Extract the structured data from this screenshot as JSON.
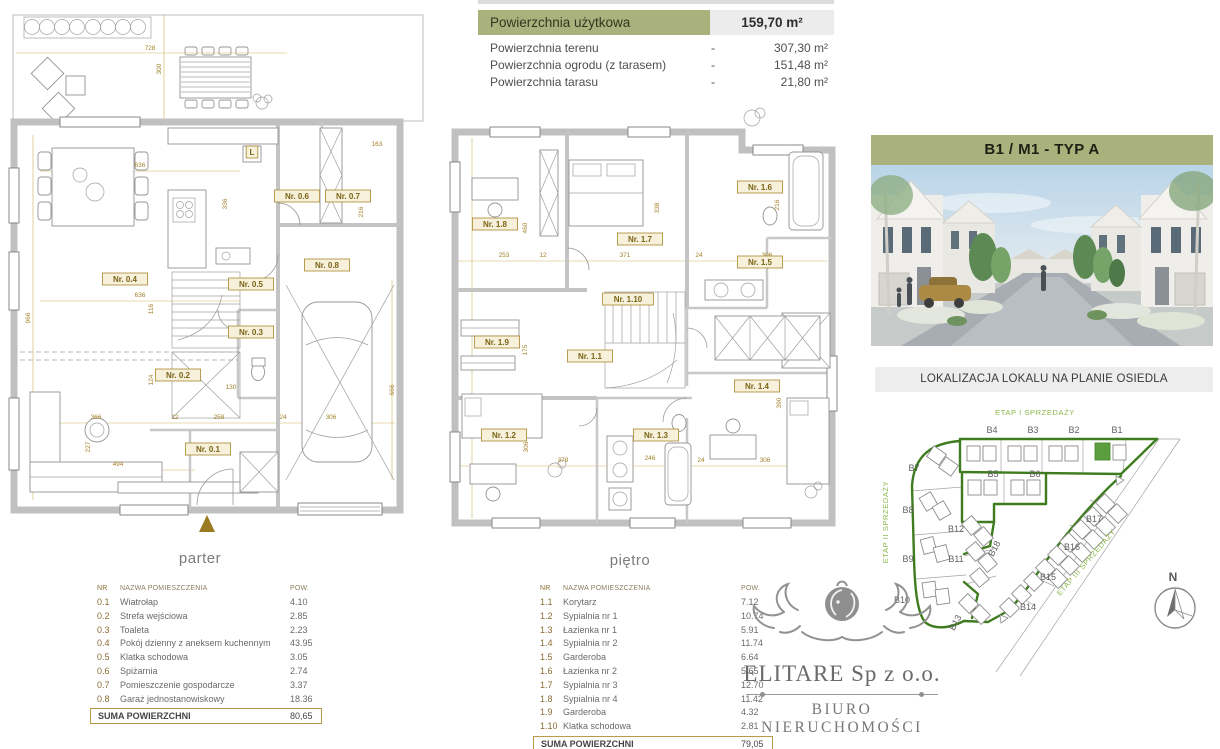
{
  "summary": {
    "header": {
      "label": "Powierzchnia użytkowa",
      "value": "159,70 m²"
    },
    "rows": [
      {
        "label": "Powierzchnia terenu",
        "dash": "-",
        "value": "307,30 m²"
      },
      {
        "label": "Powierzchnia ogrodu (z tarasem)",
        "dash": "-",
        "value": "151,48 m²"
      },
      {
        "label": "Powierzchnia tarasu",
        "dash": "-",
        "value": "21,80 m²"
      }
    ]
  },
  "unit_header": "B1 / M1 - TYP A",
  "location_title": "LOKALIZACJA LOKALU NA PLANIE OSIEDLA",
  "plans": {
    "parter": {
      "caption": "parter",
      "room_labels": [
        {
          "t": "Nr. 0.1",
          "x": 208,
          "y": 452
        },
        {
          "t": "Nr. 0.2",
          "x": 178,
          "y": 378
        },
        {
          "t": "Nr. 0.3",
          "x": 251,
          "y": 335
        },
        {
          "t": "Nr. 0.4",
          "x": 125,
          "y": 282
        },
        {
          "t": "Nr. 0.5",
          "x": 251,
          "y": 287
        },
        {
          "t": "Nr. 0.6",
          "x": 297,
          "y": 199
        },
        {
          "t": "Nr. 0.7",
          "x": 348,
          "y": 199
        },
        {
          "t": "Nr. 0.8",
          "x": 327,
          "y": 268
        },
        {
          "t": "L",
          "x": 252,
          "y": 155
        }
      ],
      "dims": [
        {
          "t": "728",
          "x": 150,
          "y": 50
        },
        {
          "t": "300",
          "x": 161,
          "y": 69,
          "r": -90
        },
        {
          "t": "636",
          "x": 140,
          "y": 167
        },
        {
          "t": "163",
          "x": 377,
          "y": 146
        },
        {
          "t": "216",
          "x": 363,
          "y": 212,
          "r": -90
        },
        {
          "t": "336",
          "x": 227,
          "y": 204,
          "r": -90
        },
        {
          "t": "636",
          "x": 140,
          "y": 297
        },
        {
          "t": "966",
          "x": 30,
          "y": 318,
          "r": -90
        },
        {
          "t": "116",
          "x": 153,
          "y": 309,
          "r": -90
        },
        {
          "t": "124",
          "x": 153,
          "y": 380,
          "r": -90
        },
        {
          "t": "366",
          "x": 96,
          "y": 419
        },
        {
          "t": "12",
          "x": 175,
          "y": 419
        },
        {
          "t": "258",
          "x": 219,
          "y": 419
        },
        {
          "t": "24",
          "x": 283,
          "y": 419
        },
        {
          "t": "306",
          "x": 331,
          "y": 419
        },
        {
          "t": "130",
          "x": 231,
          "y": 389
        },
        {
          "t": "494",
          "x": 118,
          "y": 466
        },
        {
          "t": "666",
          "x": 394,
          "y": 390,
          "r": -90
        },
        {
          "t": "227",
          "x": 90,
          "y": 447,
          "r": -90
        }
      ]
    },
    "pietro": {
      "caption": "piętro",
      "room_labels": [
        {
          "t": "Nr. 1.1",
          "x": 153,
          "y": 261
        },
        {
          "t": "Nr. 1.2",
          "x": 67,
          "y": 340
        },
        {
          "t": "Nr. 1.3",
          "x": 219,
          "y": 340
        },
        {
          "t": "Nr. 1.4",
          "x": 320,
          "y": 291
        },
        {
          "t": "Nr. 1.5",
          "x": 323,
          "y": 167
        },
        {
          "t": "Nr. 1.6",
          "x": 323,
          "y": 92
        },
        {
          "t": "Nr. 1.7",
          "x": 203,
          "y": 144
        },
        {
          "t": "Nr. 1.8",
          "x": 58,
          "y": 129
        },
        {
          "t": "Nr. 1.9",
          "x": 60,
          "y": 247
        },
        {
          "t": "Nr. 1.10",
          "x": 191,
          "y": 204
        }
      ],
      "dims": [
        {
          "t": "253",
          "x": 67,
          "y": 159
        },
        {
          "t": "12",
          "x": 106,
          "y": 159
        },
        {
          "t": "371",
          "x": 188,
          "y": 159
        },
        {
          "t": "24",
          "x": 262,
          "y": 159
        },
        {
          "t": "306",
          "x": 330,
          "y": 159
        },
        {
          "t": "460",
          "x": 90,
          "y": 130,
          "r": -90
        },
        {
          "t": "338",
          "x": 222,
          "y": 110,
          "r": -90
        },
        {
          "t": "216",
          "x": 342,
          "y": 107,
          "r": -90
        },
        {
          "t": "175",
          "x": 90,
          "y": 252,
          "r": -90
        },
        {
          "t": "378",
          "x": 126,
          "y": 364
        },
        {
          "t": "246",
          "x": 213,
          "y": 362
        },
        {
          "t": "24",
          "x": 264,
          "y": 364
        },
        {
          "t": "306",
          "x": 328,
          "y": 364
        },
        {
          "t": "306",
          "x": 91,
          "y": 349,
          "r": -90
        },
        {
          "t": "390",
          "x": 344,
          "y": 305,
          "r": -90
        }
      ]
    }
  },
  "tables": {
    "parter": {
      "headers": [
        "NR",
        "NAZWA POMIESZCZENIA",
        "POW."
      ],
      "rows": [
        [
          "0.1",
          "Wiatrołap",
          "4.10"
        ],
        [
          "0.2",
          "Strefa wejściowa",
          "2.85"
        ],
        [
          "0.3",
          "Toaleta",
          "2.23"
        ],
        [
          "0.4",
          "Pokój dzienny z aneksem kuchennym",
          "43.95"
        ],
        [
          "0.5",
          "Klatka schodowa",
          "3.05"
        ],
        [
          "0.6",
          "Spiżarnia",
          "2.74"
        ],
        [
          "0.7",
          "Pomieszczenie gospodarcze",
          "3.37"
        ],
        [
          "0.8",
          "Garaż jednostanowiskowy",
          "18.36"
        ]
      ],
      "suma_label": "SUMA POWIERZCHNI",
      "suma_value": "80,65"
    },
    "pietro": {
      "headers": [
        "NR",
        "NAZWA POMIESZCZENIA",
        "POW."
      ],
      "rows": [
        [
          "1.1",
          "Korytarz",
          "7.12"
        ],
        [
          "1.2",
          "Sypialnia nr 1",
          "10.74"
        ],
        [
          "1.3",
          "Łazienka nr 1",
          "5.91"
        ],
        [
          "1.4",
          "Sypialnia nr 2",
          "11.74"
        ],
        [
          "1.5",
          "Garderoba",
          "6.64"
        ],
        [
          "1.6",
          "Łazienka nr 2",
          "5.65"
        ],
        [
          "1.7",
          "Sypialnia nr 3",
          "12.70"
        ],
        [
          "1.8",
          "Sypialnia nr 4",
          "11.42"
        ],
        [
          "1.9",
          "Garderoba",
          "4.32"
        ],
        [
          "1.10",
          "Klatka schodowa",
          "2.81"
        ]
      ],
      "suma_label": "SUMA POWIERZCHNI",
      "suma_value": "79,05"
    }
  },
  "siteplan": {
    "etap_labels": [
      {
        "t": "ETAP I SPRZEDAŻY",
        "x": 167,
        "y": 19
      },
      {
        "t": "ETAP II SPRZEDAŻY",
        "x": 20,
        "y": 126,
        "r": -90
      },
      {
        "t": "ETAP III SPRZEDAŻY",
        "x": 220,
        "y": 168,
        "r": -49
      }
    ],
    "plot_labels": [
      {
        "t": "B4",
        "x": 124,
        "y": 37
      },
      {
        "t": "B3",
        "x": 165,
        "y": 37
      },
      {
        "t": "B2",
        "x": 206,
        "y": 37
      },
      {
        "t": "B1",
        "x": 249,
        "y": 37
      },
      {
        "t": "B5",
        "x": 125,
        "y": 81
      },
      {
        "t": "B6",
        "x": 167,
        "y": 81
      },
      {
        "t": "B7",
        "x": 46,
        "y": 75
      },
      {
        "t": "B8",
        "x": 40,
        "y": 117
      },
      {
        "t": "B9",
        "x": 40,
        "y": 166
      },
      {
        "t": "B10",
        "x": 34,
        "y": 207
      },
      {
        "t": "B12",
        "x": 88,
        "y": 136
      },
      {
        "t": "B11",
        "x": 88,
        "y": 166
      },
      {
        "t": "B18",
        "x": 129,
        "y": 154,
        "r": -62
      },
      {
        "t": "B13",
        "x": 90,
        "y": 228,
        "r": -62
      },
      {
        "t": "B17",
        "x": 226,
        "y": 126
      },
      {
        "t": "B16",
        "x": 204,
        "y": 154
      },
      {
        "t": "B15",
        "x": 180,
        "y": 184
      },
      {
        "t": "B14",
        "x": 160,
        "y": 214
      }
    ],
    "north": [
      {
        "t": "N",
        "x": 305,
        "y": 185
      }
    ],
    "highlight_plot": "B1"
  },
  "logo": {
    "company": "ELITARE Sp z o.o.",
    "subtitle": "BIURO NIERUCHOMOŚCI"
  },
  "colors": {
    "accent_olive": "#a9b27c",
    "gold_dimension": "#a3822a",
    "site_boundary_green": "#3e7c1f",
    "etap_text_green": "#8ab648",
    "highlight_green": "#5b9e3f"
  }
}
